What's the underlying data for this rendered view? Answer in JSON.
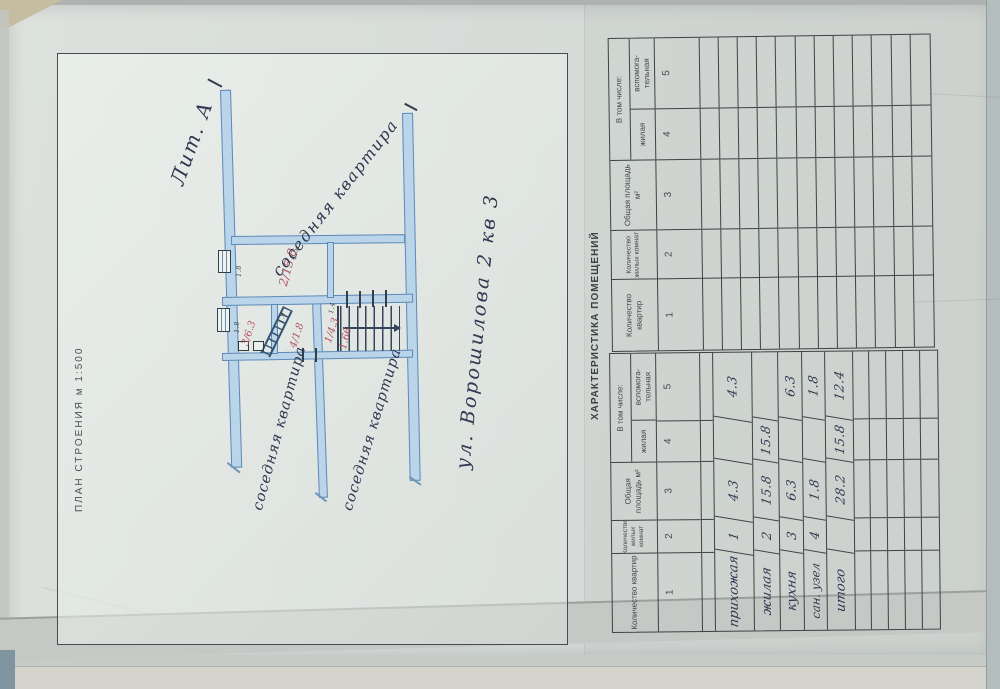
{
  "document": {
    "plan": {
      "title": "ПЛАН СТРОЕНИЯ м 1:500",
      "liter": "Лит. А",
      "street": "ул. Ворошилова 2 кв 3",
      "neighbor_label": "соседняя квартира",
      "room_labels": {
        "hall": "1/4.3",
        "living": "2/15.8",
        "kitchen": "3/6.3",
        "bath": "4/1.8",
        "stair": "1.66"
      },
      "dims": {
        "win1": "1.8",
        "win2": "1.8",
        "d1": "1.5",
        "d2": "1.9",
        "d3": "1.4"
      }
    },
    "tables": {
      "title": "ХАРАКТЕРИСТИКА ПОМЕЩЕНИЙ",
      "headers": {
        "col1": "Количество квартир",
        "col2": "Количество жилых комнат",
        "col3": "Общая площадь м²",
        "group45": "В том числе:",
        "col4": "жилая",
        "col5": "вспомога-\nтельная",
        "digits": [
          "1",
          "2",
          "3",
          "4",
          "5"
        ]
      },
      "rows": [
        {
          "name": "прихожая",
          "rooms": "1",
          "total": "4.3",
          "living": "",
          "aux": "4.3"
        },
        {
          "name": "жилая",
          "rooms": "2",
          "total": "15.8",
          "living": "15.8",
          "aux": ""
        },
        {
          "name": "кухня",
          "rooms": "3",
          "total": "6.3",
          "living": "",
          "aux": "6.3"
        },
        {
          "name": "сан. узел",
          "rooms": "4",
          "total": "1.8",
          "living": "",
          "aux": "1.8"
        },
        {
          "name": "итого",
          "rooms": "",
          "total": "28.2",
          "living": "15.8",
          "aux": "12.4"
        }
      ]
    },
    "colors": {
      "paper": "#d7dbd7",
      "plan_paper": "#e2e7e3",
      "wall_fill": "#bad4ea",
      "wall_stroke": "#5f8ab5",
      "ink": "#2e3850",
      "red_ink": "#b5525f",
      "grid_line": "#3e4245"
    }
  }
}
